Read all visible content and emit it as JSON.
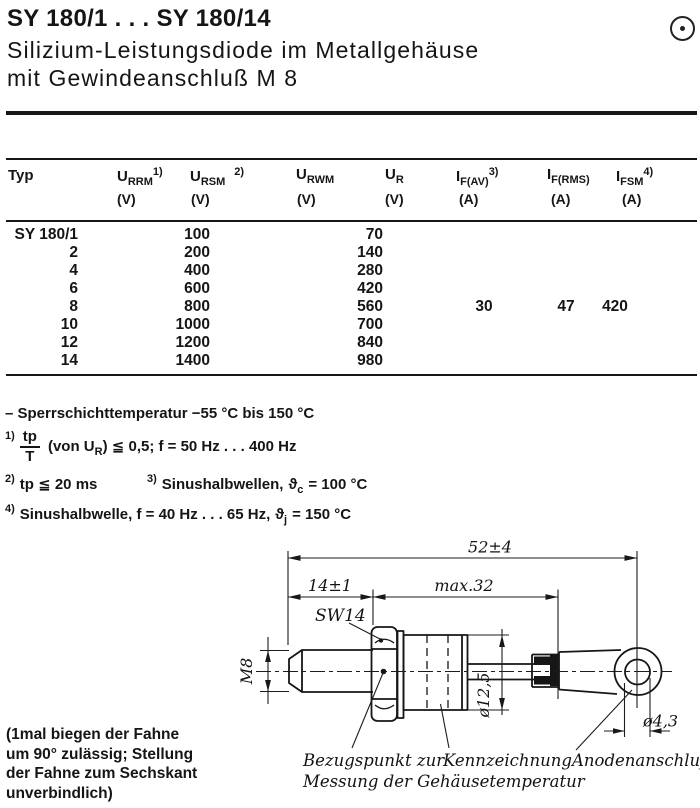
{
  "header": {
    "title": "SY 180/1 . . . SY 180/14",
    "subtitle1": "Silizium-Leistungsdiode im Metallgehäuse",
    "subtitle2": "mit Gewindeanschluß M 8"
  },
  "table": {
    "cols": {
      "typ": {
        "sym": "Typ"
      },
      "urrm": {
        "sym": "U",
        "sub": "RRM",
        "note": "1)",
        "unit": "(V)"
      },
      "ursm": {
        "sym": "U",
        "sub": "RSM",
        "note": "2)",
        "unit": "(V)"
      },
      "urwm": {
        "sym": "U",
        "sub": "RWM",
        "unit": "(V)"
      },
      "ur": {
        "sym": "U",
        "sub": "R",
        "unit": "(V)"
      },
      "ifav": {
        "sym": "I",
        "sub": "F(AV)",
        "note": "3)",
        "unit": "(A)"
      },
      "ifrms": {
        "sym": "I",
        "sub": "F(RMS)",
        "unit": "(A)"
      },
      "ifsm": {
        "sym": "I",
        "sub": "FSM",
        "note": "4)",
        "unit": "(A)"
      }
    },
    "rows": [
      {
        "typ": "SY 180/1",
        "urrm": "100",
        "urwm": "70"
      },
      {
        "typ": "2",
        "urrm": "200",
        "urwm": "140"
      },
      {
        "typ": "4",
        "urrm": "400",
        "urwm": "280"
      },
      {
        "typ": "6",
        "urrm": "600",
        "urwm": "420"
      },
      {
        "typ": "8",
        "urrm": "800",
        "urwm": "560"
      },
      {
        "typ": "10",
        "urrm": "1000",
        "urwm": "700"
      },
      {
        "typ": "12",
        "urrm": "1200",
        "urwm": "840"
      },
      {
        "typ": "14",
        "urrm": "1400",
        "urwm": "980"
      }
    ],
    "shared": {
      "ifav": "30",
      "ifrms": "47",
      "ifsm": "420"
    }
  },
  "notes": {
    "temp": "– Sperrschichttemperatur −55 °C bis 150 °C",
    "fn1": {
      "marker": "1)",
      "num": "tp",
      "den": "T",
      "pre": "(von U",
      "sub": "R",
      "post": ") ≦ 0,5; f = 50 Hz . . . 400 Hz"
    },
    "fn2": {
      "marker": "2)",
      "text": "tp ≦ 20 ms"
    },
    "fn3": {
      "marker": "3)",
      "pre": "Sinushalbwellen,",
      "theta": "ϑ",
      "sub": "c",
      "post": "= 100 °C"
    },
    "fn4": {
      "marker": "4)",
      "pre": "Sinushalbwelle, f = 40 Hz . . . 65 Hz,",
      "theta": "ϑ",
      "sub": "j",
      "post": "= 150 °C"
    }
  },
  "drawing": {
    "dim_overall": "52±4",
    "dim_thread_len": "14±1",
    "dim_body_len": "max.32",
    "wrench_size": "SW14",
    "thread": "M8",
    "body_dia": "ø12,5",
    "hole_dia": "ø4,3",
    "ref_label1": "Bezugspunkt zur",
    "ref_label2": "Messung der Gehäusetemperatur",
    "marking_label": "Kennzeichnung",
    "anode_label": "Anodenanschluß"
  },
  "side_note": {
    "line1": "(1mal biegen der Fahne",
    "line2": "um 90° zulässig; Stellung",
    "line3": "der Fahne zum Sechskant",
    "line4": "unverbindlich)"
  }
}
